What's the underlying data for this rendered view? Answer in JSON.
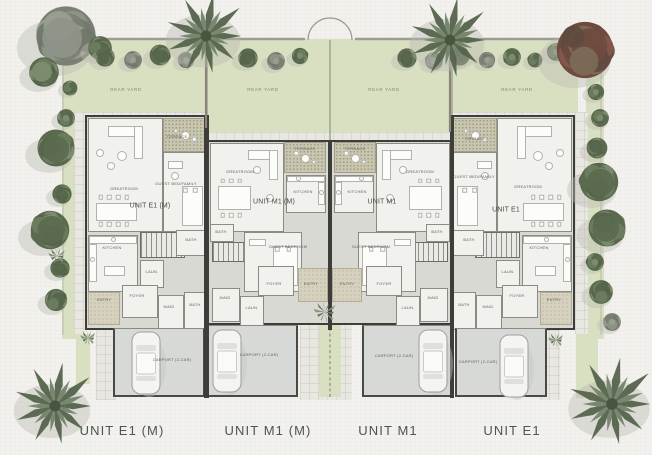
{
  "plan": {
    "bottom_labels": [
      {
        "text": "UNIT E1 (M)",
        "x": 122
      },
      {
        "text": "UNIT M1 (M)",
        "x": 268
      },
      {
        "text": "UNIT M1",
        "x": 388
      },
      {
        "text": "UNIT E1",
        "x": 512
      }
    ],
    "yard_labels": [
      {
        "text": "REAR YARD",
        "x": 126,
        "y": 90
      },
      {
        "text": "REAR YARD",
        "x": 263,
        "y": 90
      },
      {
        "text": "REAR YARD",
        "x": 384,
        "y": 90
      },
      {
        "text": "REAR YARD",
        "x": 517,
        "y": 90
      }
    ],
    "unit_names": [
      {
        "text": "UNIT E1 (M)",
        "x": 150,
        "y": 205
      },
      {
        "text": "UNIT M1 (M)",
        "x": 274,
        "y": 201
      },
      {
        "text": "UNIT M1",
        "x": 382,
        "y": 201
      },
      {
        "text": "UNIT E1",
        "x": 506,
        "y": 209
      }
    ],
    "rooms": [
      {
        "label": "GREATROOM",
        "x": 88,
        "y": 118,
        "w": 75,
        "h": 114,
        "lx": 124,
        "ly": 189,
        "furn": "great"
      },
      {
        "label": "TERRACE",
        "x": 163,
        "y": 118,
        "w": 44,
        "h": 34,
        "type": "terrace",
        "lx": 177,
        "ly": 137,
        "furn": "terr"
      },
      {
        "label": "GUEST BED/FAMILY",
        "x": 163,
        "y": 152,
        "w": 44,
        "h": 80,
        "lx": 176,
        "ly": 184,
        "furn": "bedR"
      },
      {
        "label": "KITCHEN",
        "x": 88,
        "y": 235,
        "w": 50,
        "h": 57,
        "lx": 112,
        "ly": 248,
        "furn": "kit"
      },
      {
        "label": "",
        "x": 140,
        "y": 232,
        "w": 45,
        "h": 26,
        "type": "stairs"
      },
      {
        "label": "BATH",
        "x": 176,
        "y": 230,
        "w": 31,
        "h": 26,
        "lx": 191,
        "ly": 240
      },
      {
        "label": "LAUN.",
        "x": 140,
        "y": 260,
        "w": 24,
        "h": 28,
        "lx": 152,
        "ly": 272
      },
      {
        "label": "ENTRY",
        "x": 88,
        "y": 292,
        "w": 32,
        "h": 33,
        "type": "entry",
        "lx": 104,
        "ly": 300
      },
      {
        "label": "FOYER",
        "x": 122,
        "y": 285,
        "w": 36,
        "h": 33,
        "lx": 137,
        "ly": 296
      },
      {
        "label": "MAID",
        "x": 158,
        "y": 295,
        "w": 26,
        "h": 35,
        "lx": 169,
        "ly": 307
      },
      {
        "label": "BATH",
        "x": 184,
        "y": 292,
        "w": 23,
        "h": 38,
        "lx": 195,
        "ly": 305
      },
      {
        "label": "CARPORT (2-CAR)",
        "x": 113,
        "y": 328,
        "w": 92,
        "h": 69,
        "type": "carport",
        "lx": 172,
        "ly": 360
      },
      {
        "label": "GREATROOM",
        "x": 210,
        "y": 143,
        "w": 74,
        "h": 89,
        "lx": 240,
        "ly": 172,
        "furn": "great2"
      },
      {
        "label": "TERRACE",
        "x": 284,
        "y": 142,
        "w": 42,
        "h": 31,
        "type": "terrace",
        "lx": 305,
        "ly": 149,
        "furn": "terr"
      },
      {
        "label": "KITCHEN",
        "x": 286,
        "y": 175,
        "w": 40,
        "h": 38,
        "lx": 303,
        "ly": 192,
        "furn": "kit2"
      },
      {
        "label": "BATH",
        "x": 210,
        "y": 224,
        "w": 24,
        "h": 18,
        "lx": 221,
        "ly": 232
      },
      {
        "label": "",
        "x": 212,
        "y": 242,
        "w": 46,
        "h": 20,
        "type": "stairs"
      },
      {
        "label": "GUEST BEDROOM",
        "x": 244,
        "y": 232,
        "w": 58,
        "h": 60,
        "lx": 288,
        "ly": 247,
        "furn": "bed"
      },
      {
        "label": "MAID",
        "x": 212,
        "y": 288,
        "w": 28,
        "h": 34,
        "lx": 225,
        "ly": 298
      },
      {
        "label": "LAUN.",
        "x": 240,
        "y": 296,
        "w": 24,
        "h": 30,
        "lx": 252,
        "ly": 308
      },
      {
        "label": "FOYER",
        "x": 258,
        "y": 266,
        "w": 36,
        "h": 30,
        "lx": 274,
        "ly": 284
      },
      {
        "label": "ENTRY",
        "x": 298,
        "y": 268,
        "w": 30,
        "h": 34,
        "type": "entry",
        "lx": 311,
        "ly": 284
      },
      {
        "label": "CARPORT (2-CAR)",
        "x": 207,
        "y": 325,
        "w": 91,
        "h": 72,
        "type": "carport",
        "lx": 259,
        "ly": 355
      },
      {
        "label": "GREATROOM",
        "x": 376,
        "y": 143,
        "w": 74,
        "h": 89,
        "lx": 420,
        "ly": 172,
        "furn": "great2",
        "mirror": true
      },
      {
        "label": "TERRACE",
        "x": 334,
        "y": 142,
        "w": 42,
        "h": 31,
        "type": "terrace",
        "lx": 355,
        "ly": 149,
        "furn": "terr"
      },
      {
        "label": "KITCHEN",
        "x": 334,
        "y": 175,
        "w": 40,
        "h": 38,
        "lx": 357,
        "ly": 192,
        "furn": "kit2",
        "mirror": true
      },
      {
        "label": "BATH",
        "x": 426,
        "y": 224,
        "w": 24,
        "h": 18,
        "lx": 437,
        "ly": 232
      },
      {
        "label": "",
        "x": 402,
        "y": 242,
        "w": 46,
        "h": 20,
        "type": "stairs"
      },
      {
        "label": "GUEST BEDROOM",
        "x": 358,
        "y": 232,
        "w": 58,
        "h": 60,
        "lx": 371,
        "ly": 247,
        "furn": "bed",
        "mirror": true
      },
      {
        "label": "MAID",
        "x": 420,
        "y": 288,
        "w": 28,
        "h": 34,
        "lx": 433,
        "ly": 298
      },
      {
        "label": "LAUN.",
        "x": 396,
        "y": 296,
        "w": 24,
        "h": 30,
        "lx": 408,
        "ly": 308
      },
      {
        "label": "FOYER",
        "x": 366,
        "y": 266,
        "w": 36,
        "h": 30,
        "lx": 384,
        "ly": 284
      },
      {
        "label": "ENTRY",
        "x": 332,
        "y": 268,
        "w": 30,
        "h": 34,
        "type": "entry",
        "lx": 347,
        "ly": 284
      },
      {
        "label": "CARPORT (2-CAR)",
        "x": 362,
        "y": 325,
        "w": 91,
        "h": 72,
        "type": "carport",
        "lx": 394,
        "ly": 356
      },
      {
        "label": "GREATROOM",
        "x": 497,
        "y": 118,
        "w": 75,
        "h": 114,
        "lx": 528,
        "ly": 187,
        "furn": "great",
        "mirror": true
      },
      {
        "label": "TERRACE",
        "x": 453,
        "y": 118,
        "w": 44,
        "h": 34,
        "type": "terrace",
        "lx": 475,
        "ly": 139,
        "furn": "terr"
      },
      {
        "label": "GUEST BED/FAMILY",
        "x": 453,
        "y": 152,
        "w": 44,
        "h": 80,
        "lx": 474,
        "ly": 177,
        "furn": "bedR",
        "mirror": true
      },
      {
        "label": "KITCHEN",
        "x": 522,
        "y": 235,
        "w": 50,
        "h": 57,
        "lx": 539,
        "ly": 248,
        "furn": "kit",
        "mirror": true
      },
      {
        "label": "",
        "x": 475,
        "y": 232,
        "w": 45,
        "h": 26,
        "type": "stairs"
      },
      {
        "label": "BATH",
        "x": 453,
        "y": 230,
        "w": 31,
        "h": 26,
        "lx": 469,
        "ly": 240
      },
      {
        "label": "LAUN.",
        "x": 496,
        "y": 260,
        "w": 24,
        "h": 28,
        "lx": 508,
        "ly": 272
      },
      {
        "label": "ENTRY",
        "x": 540,
        "y": 292,
        "w": 32,
        "h": 33,
        "type": "entry",
        "lx": 554,
        "ly": 300
      },
      {
        "label": "FOYER",
        "x": 502,
        "y": 285,
        "w": 36,
        "h": 33,
        "lx": 517,
        "ly": 296
      },
      {
        "label": "MAID",
        "x": 476,
        "y": 295,
        "w": 26,
        "h": 35,
        "lx": 488,
        "ly": 307
      },
      {
        "label": "BATH",
        "x": 453,
        "y": 292,
        "w": 23,
        "h": 38,
        "lx": 464,
        "ly": 305
      },
      {
        "label": "CARPORT (2-CAR)",
        "x": 455,
        "y": 328,
        "w": 92,
        "h": 69,
        "type": "carport",
        "lx": 478,
        "ly": 362
      }
    ],
    "cars": [
      {
        "x": 132,
        "y": 332
      },
      {
        "x": 213,
        "y": 330
      },
      {
        "x": 419,
        "y": 330
      },
      {
        "x": 500,
        "y": 335
      }
    ]
  },
  "trees": [
    {
      "t": "bush",
      "x": 66,
      "y": 36,
      "r": 40,
      "c": "gray"
    },
    {
      "t": "bush",
      "x": 44,
      "y": 72,
      "r": 20,
      "c": "green"
    },
    {
      "t": "bush",
      "x": 100,
      "y": 48,
      "r": 16,
      "c": "green"
    },
    {
      "t": "bush",
      "x": 105,
      "y": 57,
      "r": 13,
      "c": "green"
    },
    {
      "t": "bush",
      "x": 133,
      "y": 60,
      "r": 12,
      "c": "gray"
    },
    {
      "t": "bush",
      "x": 160,
      "y": 55,
      "r": 14,
      "c": "green"
    },
    {
      "t": "bush",
      "x": 186,
      "y": 60,
      "r": 11,
      "c": "gray"
    },
    {
      "t": "bush",
      "x": 248,
      "y": 58,
      "r": 13,
      "c": "green"
    },
    {
      "t": "bush",
      "x": 276,
      "y": 61,
      "r": 12,
      "c": "gray"
    },
    {
      "t": "bush",
      "x": 300,
      "y": 56,
      "r": 11,
      "c": "green"
    },
    {
      "t": "bush",
      "x": 407,
      "y": 58,
      "r": 13,
      "c": "green"
    },
    {
      "t": "bush",
      "x": 434,
      "y": 61,
      "r": 12,
      "c": "gray"
    },
    {
      "t": "bush",
      "x": 460,
      "y": 56,
      "r": 13,
      "c": "green"
    },
    {
      "t": "bush",
      "x": 487,
      "y": 60,
      "r": 11,
      "c": "gray"
    },
    {
      "t": "bush",
      "x": 512,
      "y": 57,
      "r": 12,
      "c": "green"
    },
    {
      "t": "bush",
      "x": 535,
      "y": 60,
      "r": 10,
      "c": "green"
    },
    {
      "t": "bush",
      "x": 556,
      "y": 52,
      "r": 12,
      "c": "green"
    },
    {
      "t": "bushRed",
      "x": 585,
      "y": 50,
      "r": 38,
      "c": "red"
    },
    {
      "t": "bush",
      "x": 70,
      "y": 88,
      "r": 10,
      "c": "green"
    },
    {
      "t": "bush",
      "x": 66,
      "y": 118,
      "r": 12,
      "c": "green"
    },
    {
      "t": "bush",
      "x": 56,
      "y": 148,
      "r": 25,
      "c": "green"
    },
    {
      "t": "bush",
      "x": 62,
      "y": 194,
      "r": 13,
      "c": "green"
    },
    {
      "t": "bush",
      "x": 50,
      "y": 230,
      "r": 26,
      "c": "green"
    },
    {
      "t": "bush",
      "x": 60,
      "y": 268,
      "r": 13,
      "c": "green"
    },
    {
      "t": "bush",
      "x": 56,
      "y": 300,
      "r": 15,
      "c": "green"
    },
    {
      "t": "bush",
      "x": 596,
      "y": 92,
      "r": 11,
      "c": "green"
    },
    {
      "t": "bush",
      "x": 600,
      "y": 118,
      "r": 12,
      "c": "green"
    },
    {
      "t": "bush",
      "x": 597,
      "y": 148,
      "r": 14,
      "c": "green"
    },
    {
      "t": "bush",
      "x": 599,
      "y": 182,
      "r": 26,
      "c": "green"
    },
    {
      "t": "bush",
      "x": 607,
      "y": 228,
      "r": 25,
      "c": "green"
    },
    {
      "t": "bush",
      "x": 595,
      "y": 262,
      "r": 12,
      "c": "green"
    },
    {
      "t": "bush",
      "x": 601,
      "y": 292,
      "r": 16,
      "c": "green"
    },
    {
      "t": "bush",
      "x": 612,
      "y": 322,
      "r": 12,
      "c": "gray"
    },
    {
      "t": "agave",
      "x": 57,
      "y": 256,
      "r": 9
    },
    {
      "t": "agave",
      "x": 88,
      "y": 338,
      "r": 8
    },
    {
      "t": "agave",
      "x": 325,
      "y": 312,
      "r": 12
    },
    {
      "t": "agave",
      "x": 556,
      "y": 340,
      "r": 8
    },
    {
      "t": "palm",
      "x": 206,
      "y": 36,
      "r": 44
    },
    {
      "t": "palm",
      "x": 450,
      "y": 40,
      "r": 44
    },
    {
      "t": "palm",
      "x": 55,
      "y": 406,
      "r": 45
    },
    {
      "t": "palm",
      "x": 612,
      "y": 404,
      "r": 48
    }
  ],
  "trunks": [
    [
      206,
      40,
      206,
      128
    ],
    [
      450,
      44,
      450,
      132
    ]
  ],
  "colors": {
    "paper": "#f2f1ed",
    "lawn": "#d9e0c1",
    "wall": "#3d3d39",
    "carport": "#d7d9d6",
    "terrace": "#c9c6b0",
    "tree_green": "#5a6a4e",
    "tree_gray": "#8f958a",
    "tree_red": "#84584a",
    "label_text": "#4d5551"
  }
}
